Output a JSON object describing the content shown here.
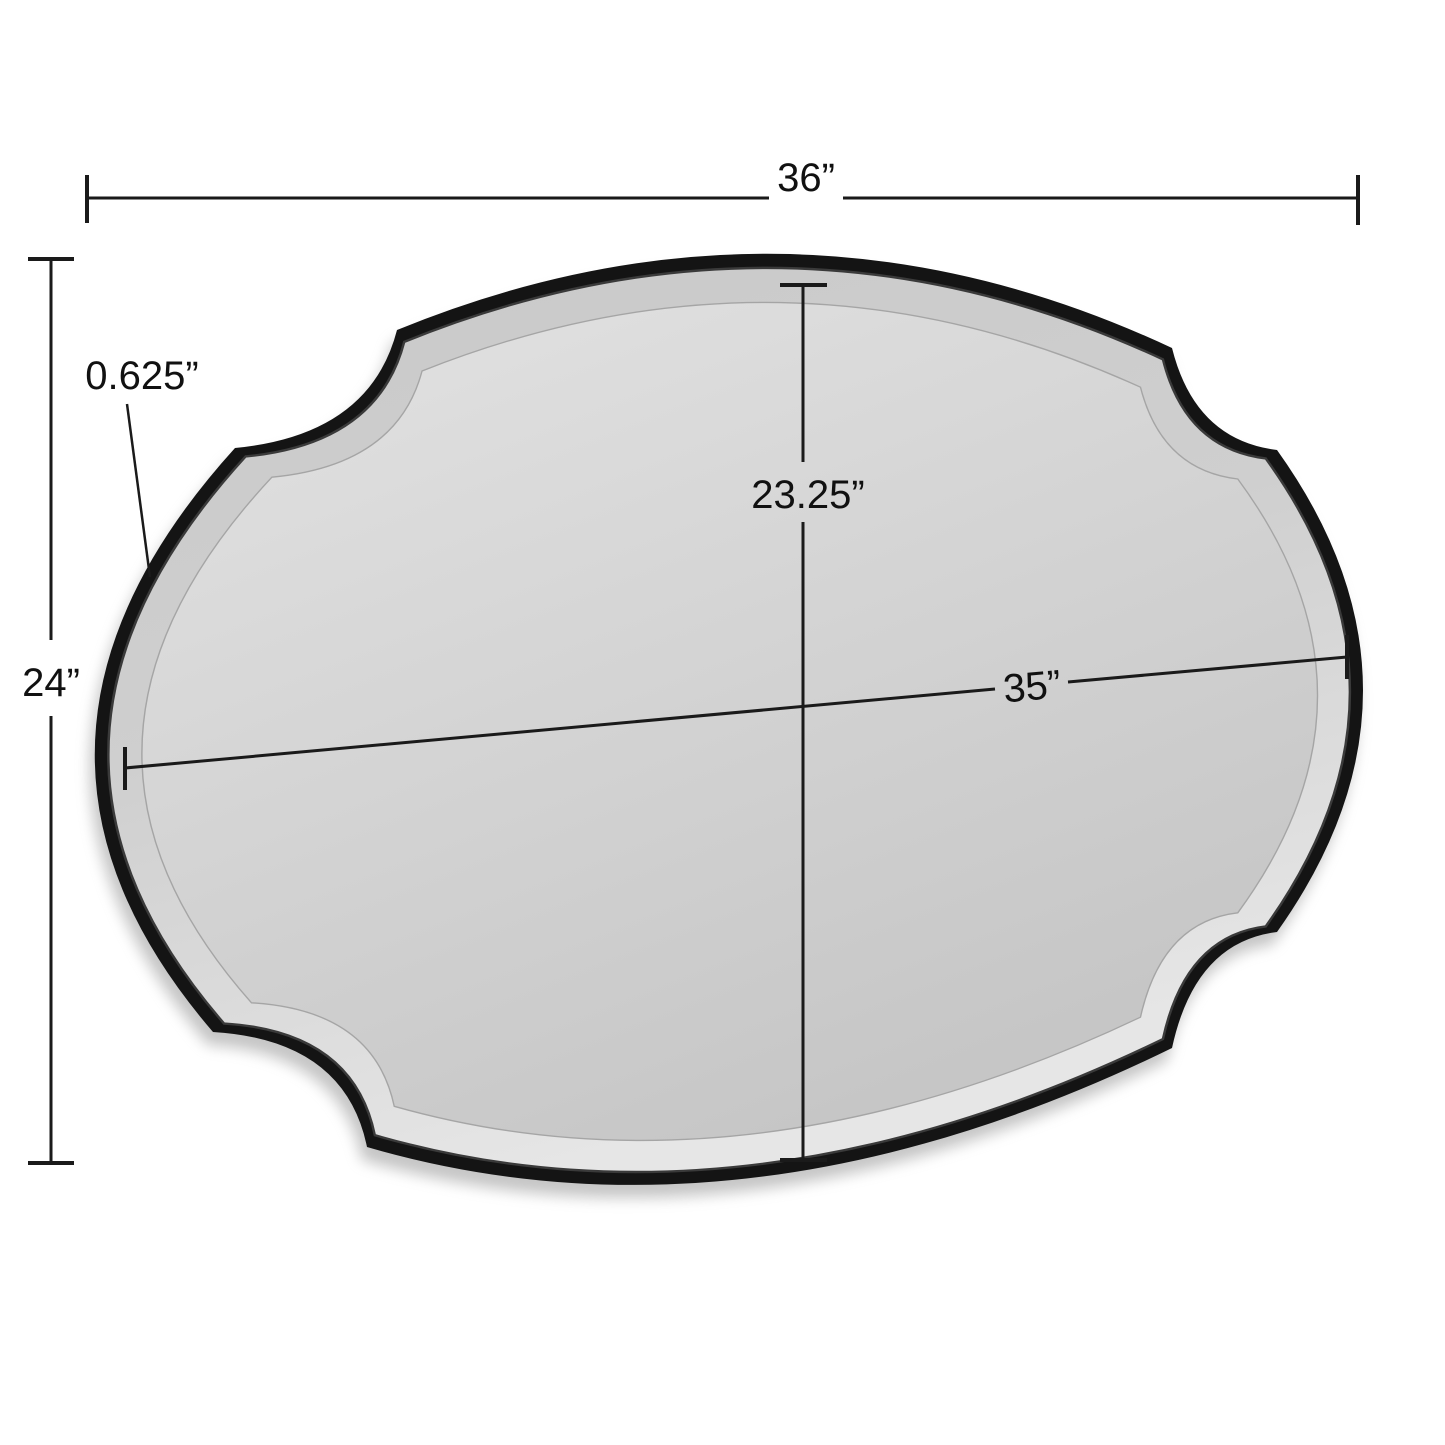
{
  "diagram": {
    "type": "product-dimension-diagram",
    "subject": "scalloped oval wall mirror with black frame",
    "background_color": "#ffffff",
    "line_color": "#1a1a1a",
    "frame_color": "#141414",
    "glass_color": "#d2d2d2",
    "labels": {
      "overall_width": "36”",
      "overall_height": "24”",
      "frame_depth": "0.625”",
      "mirror_height": "23.25”",
      "mirror_width": "35”"
    }
  }
}
